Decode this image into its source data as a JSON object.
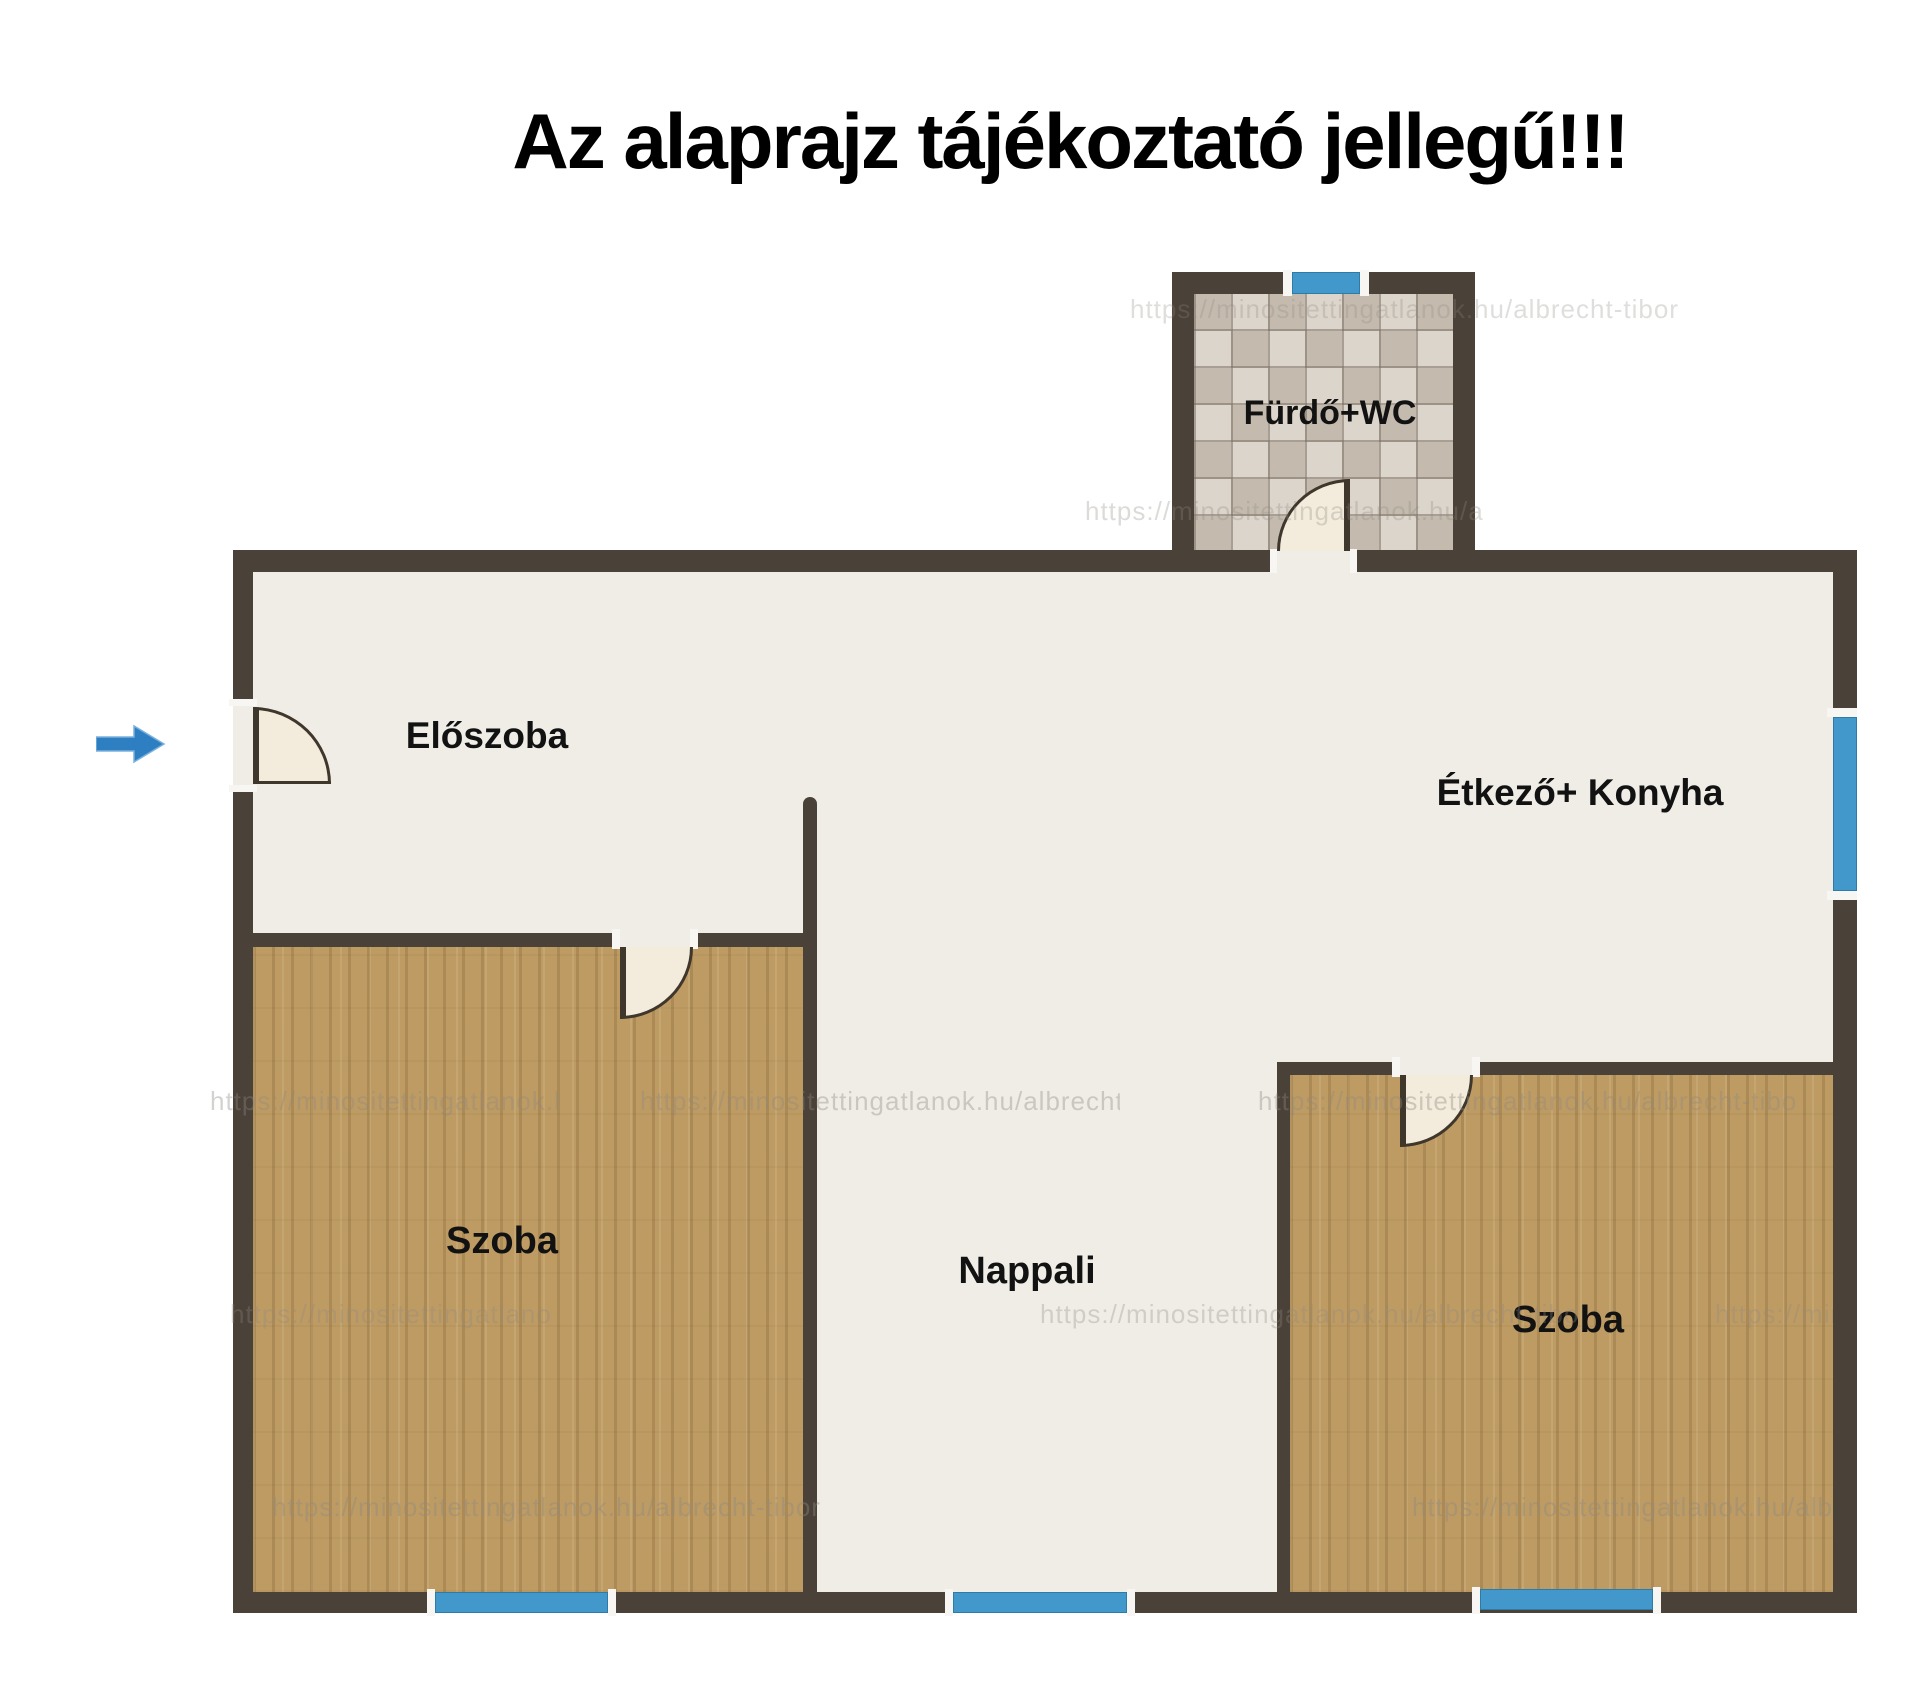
{
  "title": "Az alaprajz tájékoztató jellegű!!!",
  "rooms": {
    "bathroom": {
      "label": "Fürdő+WC"
    },
    "hallway": {
      "label": "Előszoba"
    },
    "kitchen": {
      "label": "Étkező+ Konyha"
    },
    "room_left": {
      "label": "Szoba"
    },
    "living_room": {
      "label": "Nappali"
    },
    "room_right": {
      "label": "Szoba"
    }
  },
  "watermark": {
    "text": "https://minositettingatlanok.hu/albrecht-tibor"
  },
  "colors": {
    "wall": "#4a4138",
    "floor": "#f0ede7",
    "wood_floor": "#bd9b63",
    "tile_floor": "#d2c9bd",
    "window_blue": "#4398cb",
    "door_fill": "#f3ecdc",
    "arrow_blue": "#2d7fc1",
    "title_text": "#000000"
  }
}
